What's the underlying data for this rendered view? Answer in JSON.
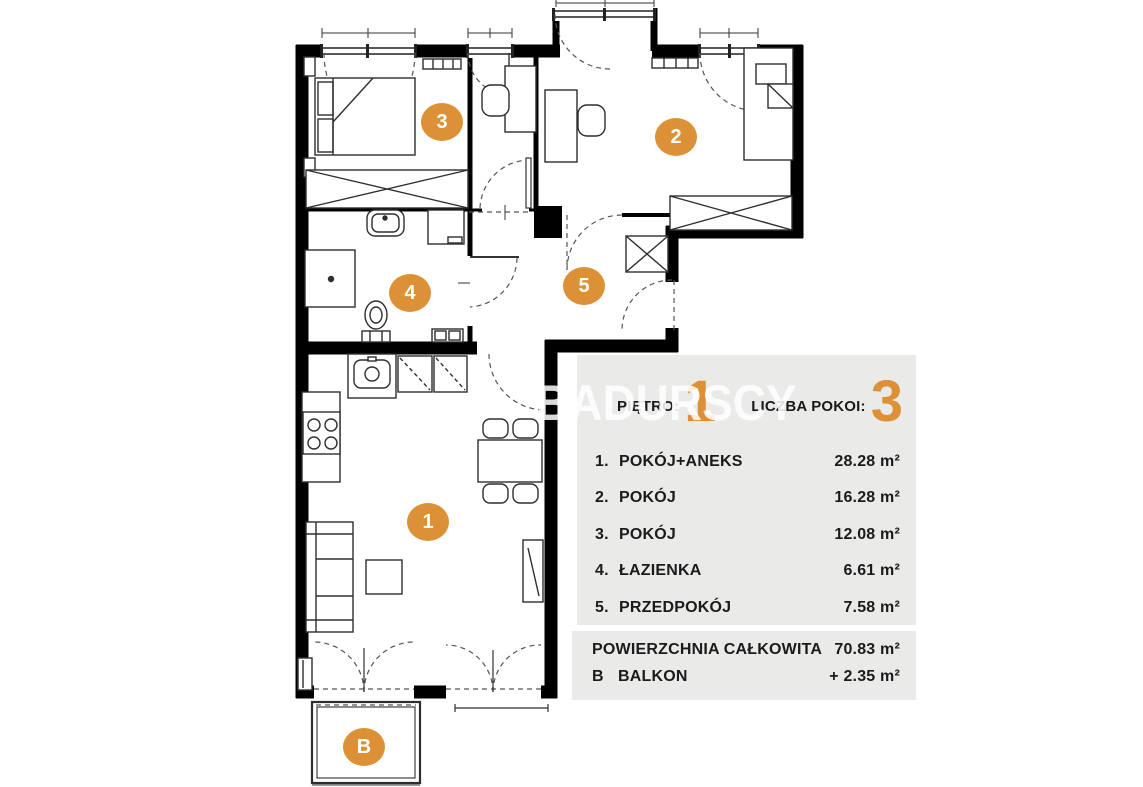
{
  "watermark": "BADURSCY",
  "colors": {
    "accent": "#DC9136",
    "panel_bg": "#EAEAE9",
    "wall": "#000000"
  },
  "panel": {
    "floor_label": "PIĘTRO:",
    "floor_value": "1",
    "rooms_count_label": "LICZBA POKOI:",
    "rooms_count_value": "3",
    "rooms": [
      {
        "no": "1.",
        "name": "POKÓJ+ANEKS",
        "area": "28.28 m²"
      },
      {
        "no": "2.",
        "name": "POKÓJ",
        "area": "16.28 m²"
      },
      {
        "no": "3.",
        "name": "POKÓJ",
        "area": "12.08 m²"
      },
      {
        "no": "4.",
        "name": "ŁAZIENKA",
        "area": "6.61 m²"
      },
      {
        "no": "5.",
        "name": "PRZEDPOKÓJ",
        "area": "7.58 m²"
      }
    ],
    "total_label": "POWIERZCHNIA CAŁKOWITA",
    "total_area": "70.83 m²",
    "balcony_letter": "B",
    "balcony_label": "BALKON",
    "balcony_area": "+  2.35 m²"
  },
  "plan_markers": [
    {
      "label": "1",
      "x": 428,
      "y": 522
    },
    {
      "label": "2",
      "x": 676,
      "y": 137
    },
    {
      "label": "3",
      "x": 442,
      "y": 122
    },
    {
      "label": "4",
      "x": 410,
      "y": 293
    },
    {
      "label": "5",
      "x": 584,
      "y": 286
    },
    {
      "label": "B",
      "x": 364,
      "y": 747
    }
  ]
}
